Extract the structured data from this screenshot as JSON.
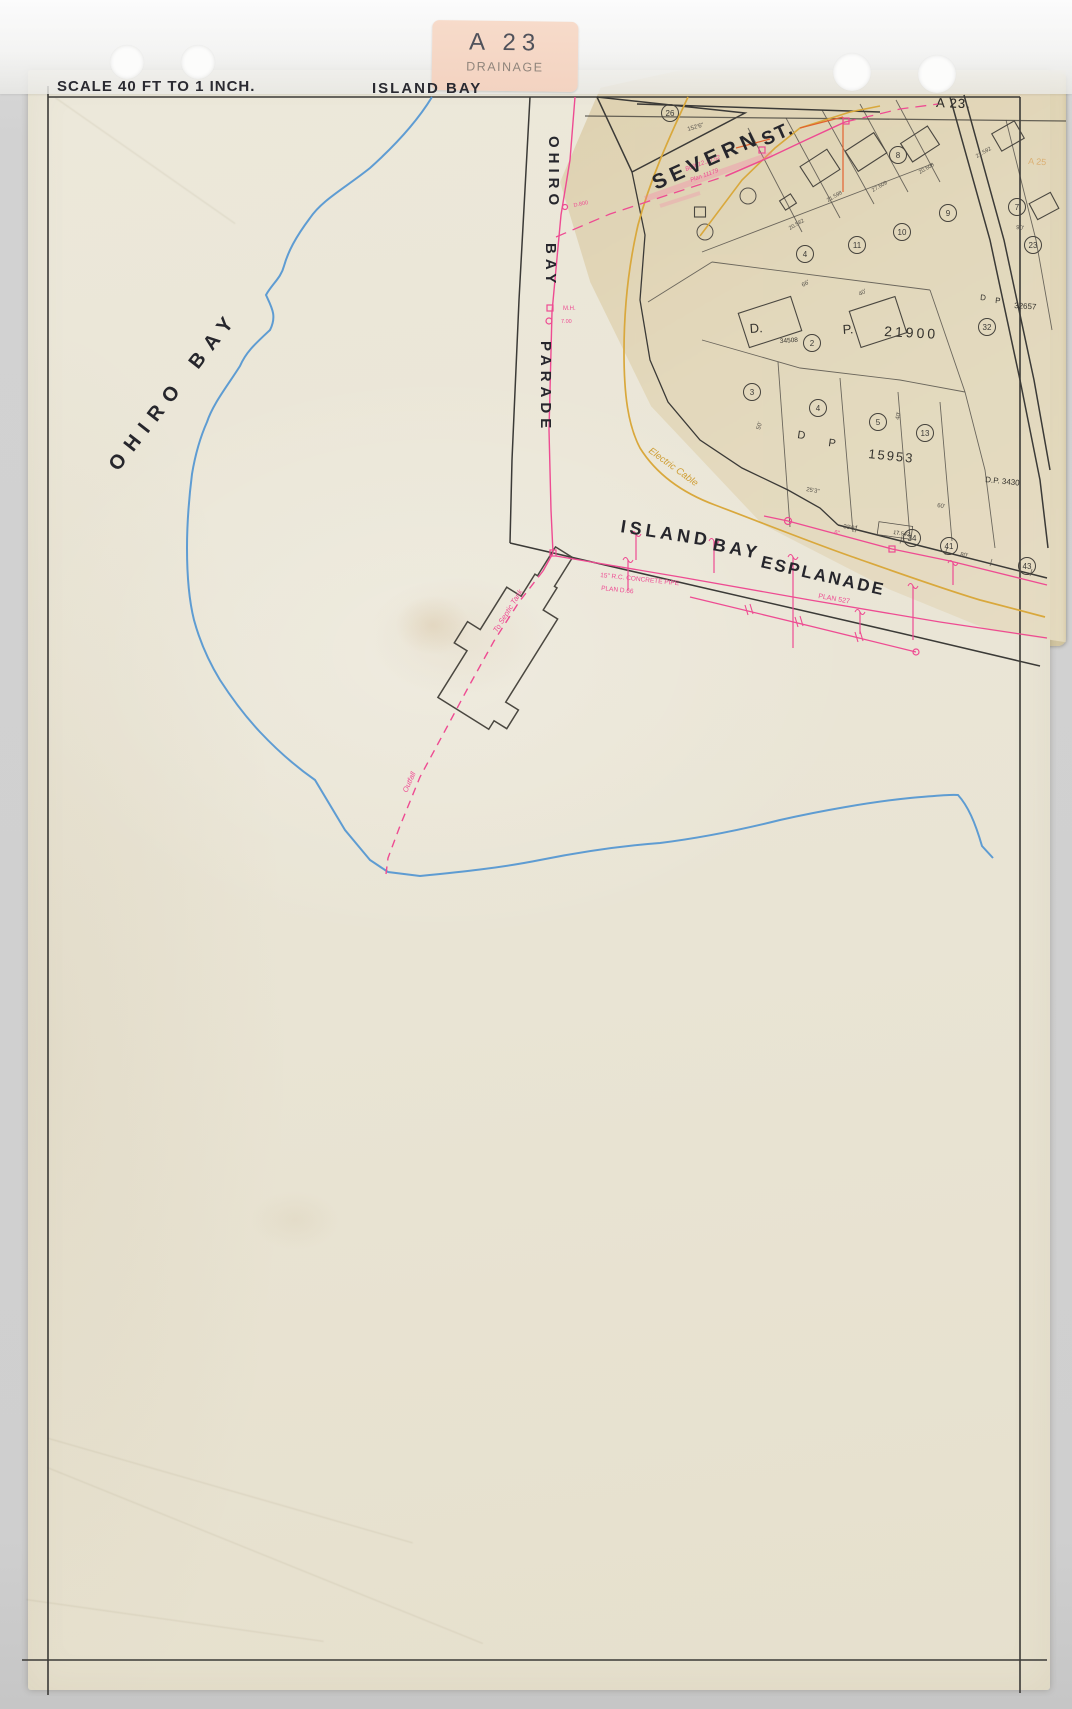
{
  "header": {
    "scale_label": "SCALE 40 FT TO 1 INCH.",
    "sheet_title": "ISLAND BAY",
    "corner_ref": "A 23."
  },
  "sticker": {
    "ref": "A 23",
    "category": "DRAINAGE"
  },
  "binding": {
    "punch_count": 4
  },
  "streets": {
    "ohiro_1": "OHIRO",
    "ohiro_2": "BAY",
    "parade_1": "OHIRO",
    "parade_2": "BAY",
    "parade_3": "PARADE",
    "severn": "SEVERN",
    "severn_st": "ST.",
    "esp_1": "ISLAND",
    "esp_2": "BAY",
    "esp_3": "ESPLANADE",
    "cable_note": "Electric Cable"
  },
  "survey_texts": [
    {
      "t": "D.",
      "x": 750,
      "y": 333,
      "s": 13,
      "r": -4
    },
    {
      "t": "P.",
      "x": 843,
      "y": 334,
      "s": 13,
      "r": -4
    },
    {
      "t": "21900",
      "x": 884,
      "y": 336,
      "s": 14,
      "r": 3,
      "ls": 3
    },
    {
      "t": "34508",
      "x": 780,
      "y": 343,
      "s": 6.5,
      "r": -4
    },
    {
      "t": "D",
      "x": 797,
      "y": 438,
      "s": 11,
      "r": 8
    },
    {
      "t": "P",
      "x": 828,
      "y": 446,
      "s": 11,
      "r": 8
    },
    {
      "t": "15953",
      "x": 868,
      "y": 458,
      "s": 13,
      "r": 6,
      "ls": 2
    },
    {
      "t": "D.P. 3430",
      "x": 985,
      "y": 482,
      "s": 8,
      "r": 6
    },
    {
      "t": "D",
      "x": 980,
      "y": 300,
      "s": 8,
      "r": 4
    },
    {
      "t": "P",
      "x": 995,
      "y": 303,
      "s": 8,
      "r": 4
    },
    {
      "t": "32657",
      "x": 1014,
      "y": 308,
      "s": 8,
      "r": 4
    },
    {
      "t": "17.542",
      "x": 893,
      "y": 534,
      "s": 5.5,
      "r": 8
    },
    {
      "t": "A 25",
      "x": 1028,
      "y": 164,
      "s": 9,
      "r": 4,
      "c": "#d8a25a",
      "o": 0.75
    },
    {
      "t": "A 23.",
      "x": 936,
      "y": 107,
      "s": 13,
      "r": 2,
      "ls": 1
    }
  ],
  "house_numbers": [
    {
      "t": "20.582",
      "x": 790,
      "y": 230,
      "r": -30
    },
    {
      "t": "21.598",
      "x": 828,
      "y": 202,
      "r": -30
    },
    {
      "t": "27.609",
      "x": 873,
      "y": 192,
      "r": -30
    },
    {
      "t": "20.608",
      "x": 920,
      "y": 174,
      "r": -30
    },
    {
      "t": "21.592",
      "x": 977,
      "y": 158,
      "r": -30
    }
  ],
  "dimensions": [
    {
      "t": "152'6\"",
      "x": 688,
      "y": 131,
      "r": -16
    },
    {
      "t": "66'",
      "x": 803,
      "y": 287,
      "r": -30
    },
    {
      "t": "40'",
      "x": 860,
      "y": 296,
      "r": -30
    },
    {
      "t": "25'3\"",
      "x": 806,
      "y": 491,
      "r": 10
    },
    {
      "t": "33'9\"",
      "x": 843,
      "y": 528,
      "r": 10
    },
    {
      "t": "80'",
      "x": 960,
      "y": 556,
      "r": 10
    },
    {
      "t": "60'",
      "x": 937,
      "y": 507,
      "r": 9
    },
    {
      "t": "90'",
      "x": 1016,
      "y": 229,
      "r": 6
    },
    {
      "t": "40'",
      "x": 899,
      "y": 420,
      "r": -78
    },
    {
      "t": "50'",
      "x": 760,
      "y": 430,
      "r": -75
    }
  ],
  "lot_numbers": [
    {
      "n": "4",
      "x": 805,
      "y": 254
    },
    {
      "n": "11",
      "x": 857,
      "y": 245
    },
    {
      "n": "10",
      "x": 902,
      "y": 232
    },
    {
      "n": "9",
      "x": 948,
      "y": 213
    },
    {
      "n": "7",
      "x": 1017,
      "y": 207
    },
    {
      "n": "23",
      "x": 1033,
      "y": 245
    },
    {
      "n": "32",
      "x": 987,
      "y": 327
    },
    {
      "n": "2",
      "x": 812,
      "y": 343
    },
    {
      "n": "3",
      "x": 752,
      "y": 392
    },
    {
      "n": "4",
      "x": 818,
      "y": 408
    },
    {
      "n": "5",
      "x": 878,
      "y": 422
    },
    {
      "n": "13",
      "x": 925,
      "y": 433
    },
    {
      "n": "26",
      "x": 670,
      "y": 113
    },
    {
      "n": "8",
      "x": 898,
      "y": 155
    },
    {
      "n": "34",
      "x": 912,
      "y": 538
    },
    {
      "n": "41",
      "x": 949,
      "y": 546
    },
    {
      "n": "43",
      "x": 1027,
      "y": 566
    }
  ],
  "pink_notes": [
    {
      "t": "M.H.",
      "x": 563,
      "y": 310,
      "s": 6,
      "r": 0
    },
    {
      "t": "7.00",
      "x": 561,
      "y": 323,
      "s": 5.5,
      "r": 0
    },
    {
      "t": "D.800",
      "x": 574,
      "y": 207,
      "s": 5.5,
      "r": -12
    },
    {
      "t": "15\" R.C. CONCRETE PIPE",
      "x": 600,
      "y": 577,
      "s": 6.5,
      "r": 6
    },
    {
      "t": "PLAN D.66",
      "x": 601,
      "y": 590,
      "s": 6.5,
      "r": 6
    },
    {
      "t": "PLAN 527",
      "x": 818,
      "y": 598,
      "s": 7,
      "r": 10
    },
    {
      "t": "Built 12.10.52",
      "x": 686,
      "y": 171,
      "s": 6,
      "r": -20,
      "i": 1
    },
    {
      "t": "Plan 11179",
      "x": 691,
      "y": 182,
      "s": 6,
      "r": -20,
      "i": 1
    },
    {
      "t": "To Septic Tank",
      "x": 497,
      "y": 633,
      "s": 7.5,
      "r": -58,
      "i": 1
    },
    {
      "t": "Outfall",
      "x": 407,
      "y": 793,
      "s": 7.5,
      "r": -66,
      "i": 1
    },
    {
      "t": "6\"",
      "x": 834,
      "y": 534,
      "s": 6,
      "r": 10
    }
  ],
  "colors": {
    "ink": "#3b3a37",
    "cadastral": "#56524b",
    "house": "#4a4740",
    "pink": "#ee4b92",
    "pink_glow": "#ff6aa8",
    "blue": "#4f93d2",
    "yellow": "#d9a83c",
    "red": "#e2622f",
    "sheet": "#ebe7d9",
    "tan": "#e0d5b8",
    "sticker": "#f5d7c6"
  }
}
